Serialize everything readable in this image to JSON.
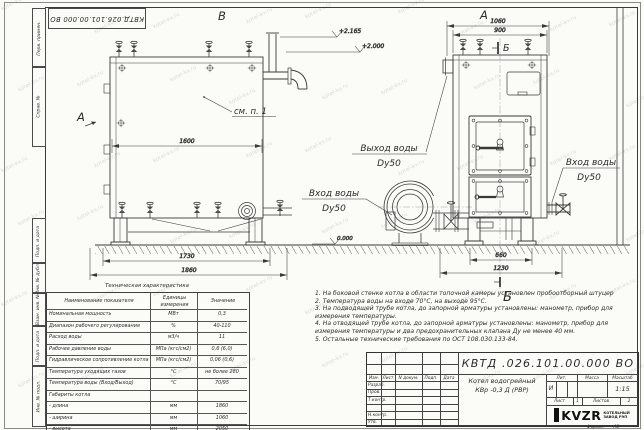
{
  "watermark": {
    "text": "kotel-kv.ru"
  },
  "frame": {
    "doc_number_top": "КВТД.026.101.00.000  ВО",
    "side_labels": [
      "Перв. примен.",
      "Справ. №",
      "Подп. и дата",
      "Инв. № дубл.",
      "Взам. инв. №",
      "Подп. и дата",
      "Инв. № подл."
    ],
    "format_label": "Формат",
    "format_value": "А3"
  },
  "drawing": {
    "view_labels": {
      "top_v": "В",
      "top_a": "А",
      "side_a": "А",
      "section_b_top": "Б",
      "section_b_bottom": "Б"
    },
    "callout_see_note": "см. п. 1",
    "labels": {
      "outlet": "Выход воды",
      "outlet_dn": "Dy50",
      "inlet_left": "Вход воды",
      "inlet_left_dn": "Dy50",
      "inlet_right": "Вход воды",
      "inlet_right_dn": "Dy50"
    },
    "elevations": {
      "chimney": "+2.165",
      "top": "+2.000",
      "zero": "0.000"
    },
    "dims": {
      "d1600": "1600",
      "d1730": "1730",
      "d1860": "1860",
      "d1060": "1060",
      "d900": "900",
      "d660": "660",
      "d1230": "1230"
    }
  },
  "tech_table": {
    "title": "Техническая характеристика",
    "headers": {
      "name": "Наименование показателя",
      "units": "Единицы измерения",
      "value": "Значение"
    },
    "rows": [
      {
        "name": "Номинальная мощность",
        "units": "МВт",
        "value": "0,3"
      },
      {
        "name": "Диапазон рабочего регулирования",
        "units": "%",
        "value": "40-110"
      },
      {
        "name": "Расход воды",
        "units": "м3/ч",
        "value": "11"
      },
      {
        "name": "Рабочее давление воды",
        "units": "МПа (кгс/см2)",
        "value": "0,6 (6,0)"
      },
      {
        "name": "Гидравлическое сопротивление котла",
        "units": "МПа (кгс/см2)",
        "value": "0,06 (0,6)"
      },
      {
        "name": "Температура уходящих газов",
        "units": "°С",
        "value": "не более 280"
      },
      {
        "name": "Температура воды (Вход/Выход)",
        "units": "°С",
        "value": "70/95"
      },
      {
        "name": "Габариты котла",
        "units": "",
        "value": ""
      },
      {
        "name": "- длина",
        "units": "мм",
        "value": "1860"
      },
      {
        "name": "- ширина",
        "units": "мм",
        "value": "1060"
      },
      {
        "name": "- высота",
        "units": "мм",
        "value": "2050"
      }
    ]
  },
  "notes": [
    "1. На боковой стенке котла в области топочной камеры установлен пробоотборный штуцер",
    "2. Температура воды на входе 70°С, на выходе 95°С.",
    "3. На подводящей трубе котла, до запорной арматуры установлены: манометр, прибор для измерения температуры.",
    "4. На отводящей трубе котла, до запорной арматуры установлены: манометр, прибор для измерения температуры и два предохранительных клапана Ду не менее 40 мм.",
    "5. Остальные технические требования по ОСТ 108.030.133-84."
  ],
  "title_block": {
    "doc_number": "КВТД .026.101.00.000  ВО",
    "product_name_1": "Котел водогрейный",
    "product_name_2": "КВр -0,3  Д  (РВР)",
    "col_headers": [
      "Изм.",
      "Лист",
      "N докум.",
      "Подп.",
      "Дата"
    ],
    "row_labels": [
      "Разраб.",
      "Пров.",
      "Т.контр.",
      "Н.контр.",
      "Утв."
    ],
    "lit_header": "Лит.",
    "mass_header": "Масса",
    "scale_header": "Масштаб",
    "lit_value": "И",
    "scale_value": "1:15",
    "sheet_label": "Лист",
    "sheet_value": "1",
    "sheets_label": "Листов",
    "sheets_value": "2",
    "company": "KVZR",
    "company_sub1": "КОТЕЛЬНЫЙ",
    "company_sub2": "ЗАВОД РЭП"
  }
}
